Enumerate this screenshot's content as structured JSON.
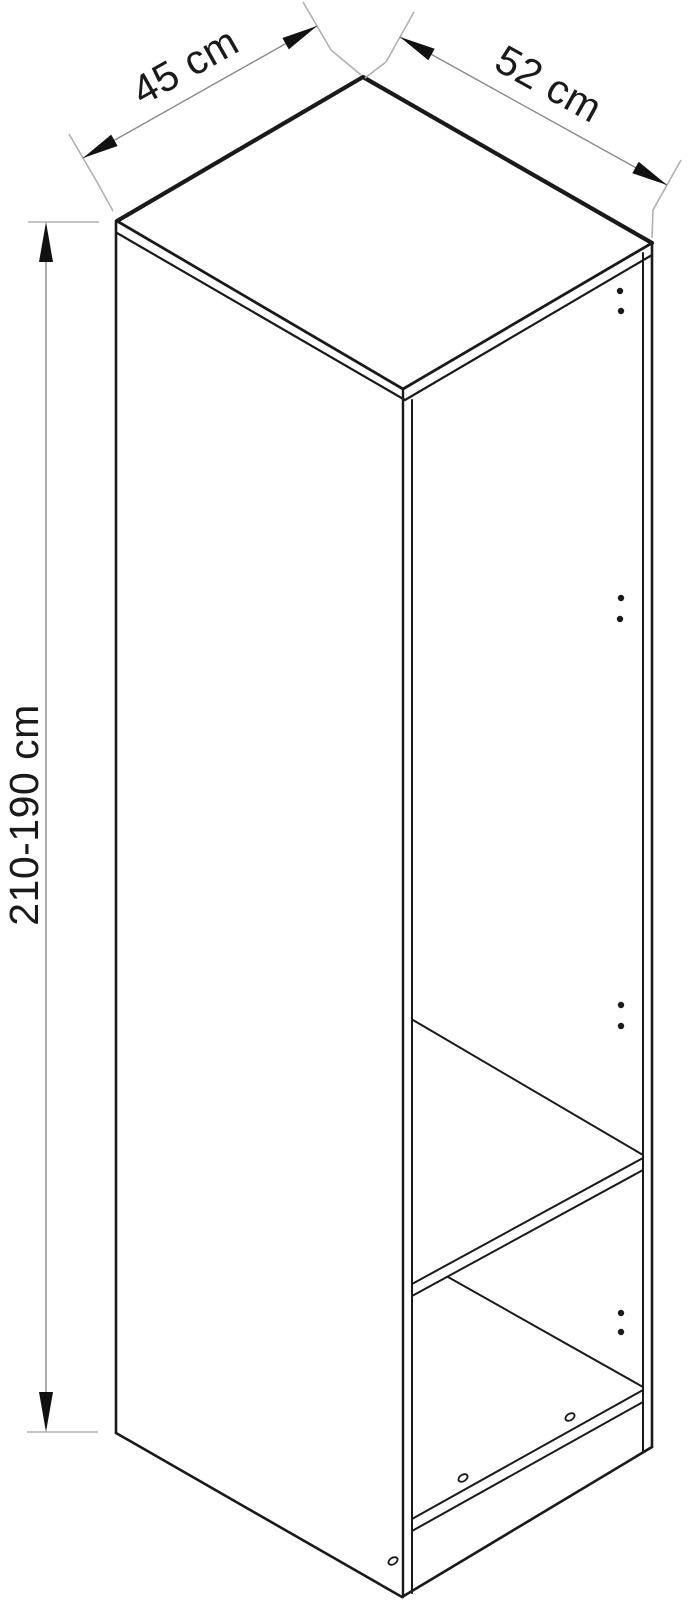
{
  "page": {
    "background": "#ffffff"
  },
  "diagram": {
    "name": "wardrobe-dimension-diagram",
    "dimensions": {
      "width": {
        "label": "45 cm"
      },
      "depth": {
        "label": "52 cm"
      },
      "height": {
        "label": "210-190 cm"
      }
    },
    "colors": {
      "outline": "#1a1a1a",
      "dimension_line": "#8a8a8a",
      "extension_tick": "#b0b0b0",
      "arrowhead": "#111111",
      "text": "#1a1a1a",
      "background": "#ffffff"
    }
  }
}
